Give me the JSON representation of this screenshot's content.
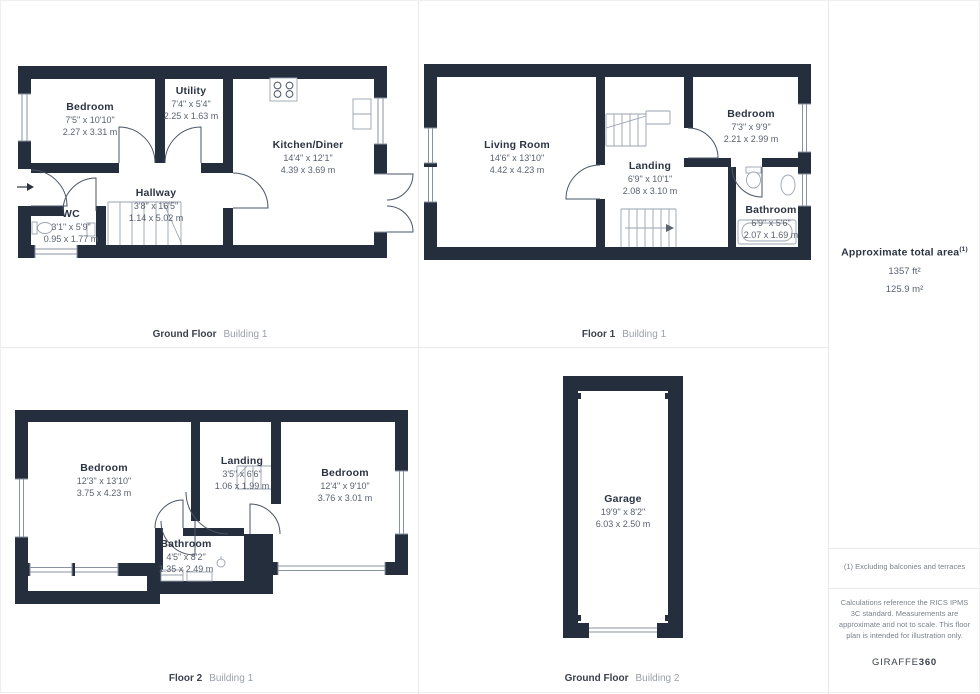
{
  "colors": {
    "wall": "#242e3c",
    "door": "#4a5566",
    "fixture": "#9aa3b0",
    "winline": "#8a93a1",
    "room_name": "#2c3444",
    "room_dim": "#5a6270",
    "caption_strong": "#3b414d",
    "caption_muted": "#9aa0aa",
    "note": "#7b828c",
    "divider": "#e9e9e9"
  },
  "plans": {
    "p1": {
      "floor": "Ground Floor",
      "building": "Building 1",
      "rooms": {
        "bedroom": {
          "name": "Bedroom",
          "ft": "7'5\" x 10'10\"",
          "m": "2.27 x 3.31 m"
        },
        "utility": {
          "name": "Utility",
          "ft": "7'4\" x 5'4\"",
          "m": "2.25 x 1.63 m"
        },
        "kitchen": {
          "name": "Kitchen/Diner",
          "ft": "14'4\" x 12'1\"",
          "m": "4.39 x 3.69 m"
        },
        "hallway": {
          "name": "Hallway",
          "ft": "3'8\" x 16'5\"",
          "m": "1.14 x 5.02 m"
        },
        "wc": {
          "name": "WC",
          "ft": "3'1\" x 5'9\"",
          "m": "0.95 x 1.77 m"
        }
      }
    },
    "p2": {
      "floor": "Floor 1",
      "building": "Building 1",
      "rooms": {
        "living": {
          "name": "Living Room",
          "ft": "14'6\" x 13'10\"",
          "m": "4.42 x 4.23 m"
        },
        "landing": {
          "name": "Landing",
          "ft": "6'9\" x 10'1\"",
          "m": "2.08 x 3.10 m"
        },
        "bedroom": {
          "name": "Bedroom",
          "ft": "7'3\" x 9'9\"",
          "m": "2.21 x 2.99 m"
        },
        "bathroom": {
          "name": "Bathroom",
          "ft": "6'9\" x 5'6\"",
          "m": "2.07 x 1.69 m"
        }
      }
    },
    "p3": {
      "floor": "Floor 2",
      "building": "Building 1",
      "rooms": {
        "bedroom_left": {
          "name": "Bedroom",
          "ft": "12'3\" x 13'10\"",
          "m": "3.75 x 4.23 m"
        },
        "landing": {
          "name": "Landing",
          "ft": "3'5\" x 6'6\"",
          "m": "1.06 x 1.99 m"
        },
        "bedroom_right": {
          "name": "Bedroom",
          "ft": "12'4\" x 9'10\"",
          "m": "3.76 x 3.01 m"
        },
        "bathroom": {
          "name": "Bathroom",
          "ft": "4'5\" x 8'2\"",
          "m": "1.35 x 2.49 m"
        }
      }
    },
    "p4": {
      "floor": "Ground Floor",
      "building": "Building 2",
      "rooms": {
        "garage": {
          "name": "Garage",
          "ft": "19'9\" x 8'2\"",
          "m": "6.03 x 2.50 m"
        }
      }
    }
  },
  "summary": {
    "title": "Approximate total area",
    "sup": "(1)",
    "ft": "1357 ft²",
    "m": "125.9 m²"
  },
  "notes": {
    "n1": "(1) Excluding balconies and terraces",
    "n2": "Calculations reference the RICS IPMS 3C standard. Measurements are approximate and not to scale. This floor plan is intended for illustration only."
  },
  "logo": {
    "brand": "GIRAFFE",
    "suffix": "360"
  }
}
